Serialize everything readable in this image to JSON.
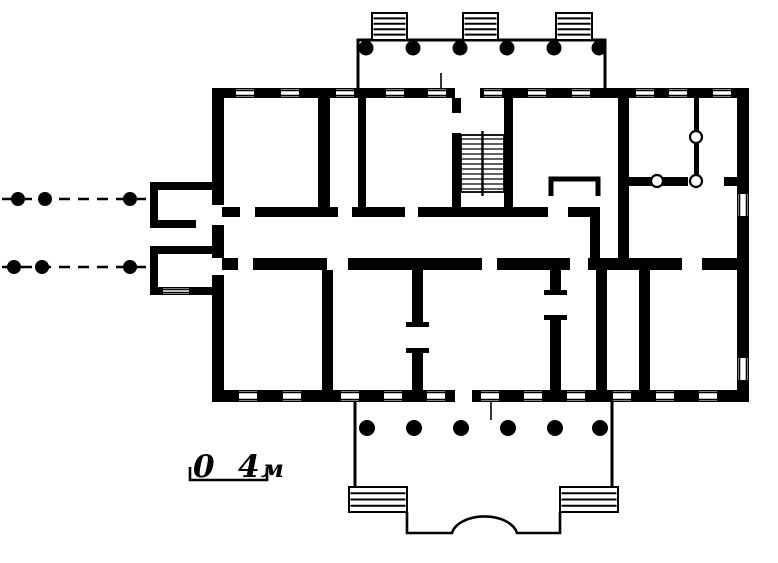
{
  "colors": {
    "ink": "#000000",
    "paper": "#ffffff"
  },
  "scale_bar": {
    "zero": "0",
    "four": "4",
    "unit": "м"
  },
  "porticos": {
    "top": {
      "column_count": 6,
      "column_x": [
        366,
        413,
        460,
        507,
        554,
        599
      ],
      "column_y": 48,
      "column_r": 7.5,
      "stair_flights": 3
    },
    "bottom": {
      "column_count": 6,
      "column_x": [
        367,
        414,
        461,
        508,
        555,
        600
      ],
      "column_y": 428,
      "column_r": 8,
      "stair_flights": 2
    }
  },
  "interior_columns": [
    {
      "x": 657,
      "y": 181
    },
    {
      "x": 696,
      "y": 181
    },
    {
      "x": 696,
      "y": 137
    }
  ],
  "approach_axes": [
    {
      "y": 199,
      "dot_x": [
        18,
        45,
        130
      ]
    },
    {
      "y": 267,
      "dot_x": [
        14,
        42,
        130
      ]
    }
  ],
  "windows": {
    "top_wall_x": [
      245,
      290,
      345,
      395,
      437,
      493,
      537,
      581,
      645,
      678,
      722
    ],
    "bottom_wall_x": [
      248,
      292,
      350,
      393,
      436,
      490,
      533,
      576,
      622,
      665,
      708
    ],
    "right_wall_y": [
      205,
      369
    ],
    "porch_wall_x": [
      176
    ]
  }
}
